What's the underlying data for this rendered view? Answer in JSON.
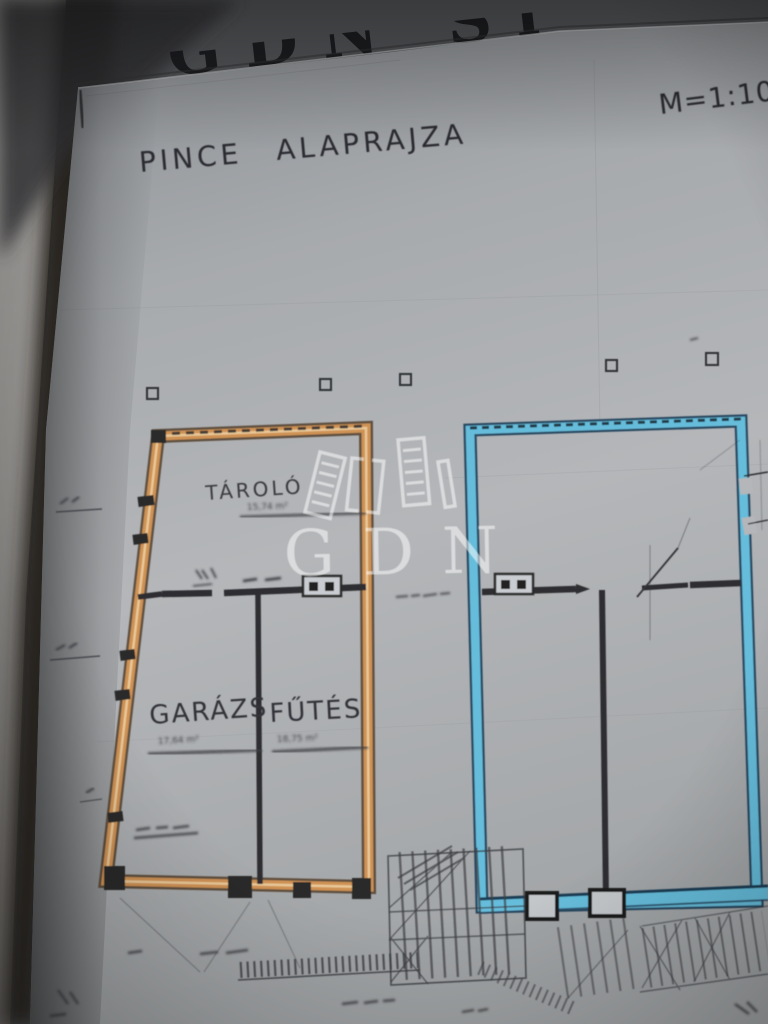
{
  "photo": {
    "top_clipped_text": "GDN Si",
    "watermark_text": "GDN"
  },
  "plan": {
    "title_word1": "PINCE",
    "title_word2": "ALAPRAJZA",
    "scale": "M=1:10",
    "rooms": [
      {
        "name": "TÁROLÓ",
        "area": "15,74 m²"
      },
      {
        "name": "GARÁZS",
        "area": "17,64 m²"
      },
      {
        "name": "FŰTÉS",
        "area": "18,75 m²"
      }
    ],
    "symbols": {
      "window_box": "double-pane-window"
    },
    "colors": {
      "left_building_highlight": "#cf9254",
      "right_building_highlight": "#66bddb",
      "ink": "#2e2f33",
      "paper": "#b0b3b7"
    }
  }
}
